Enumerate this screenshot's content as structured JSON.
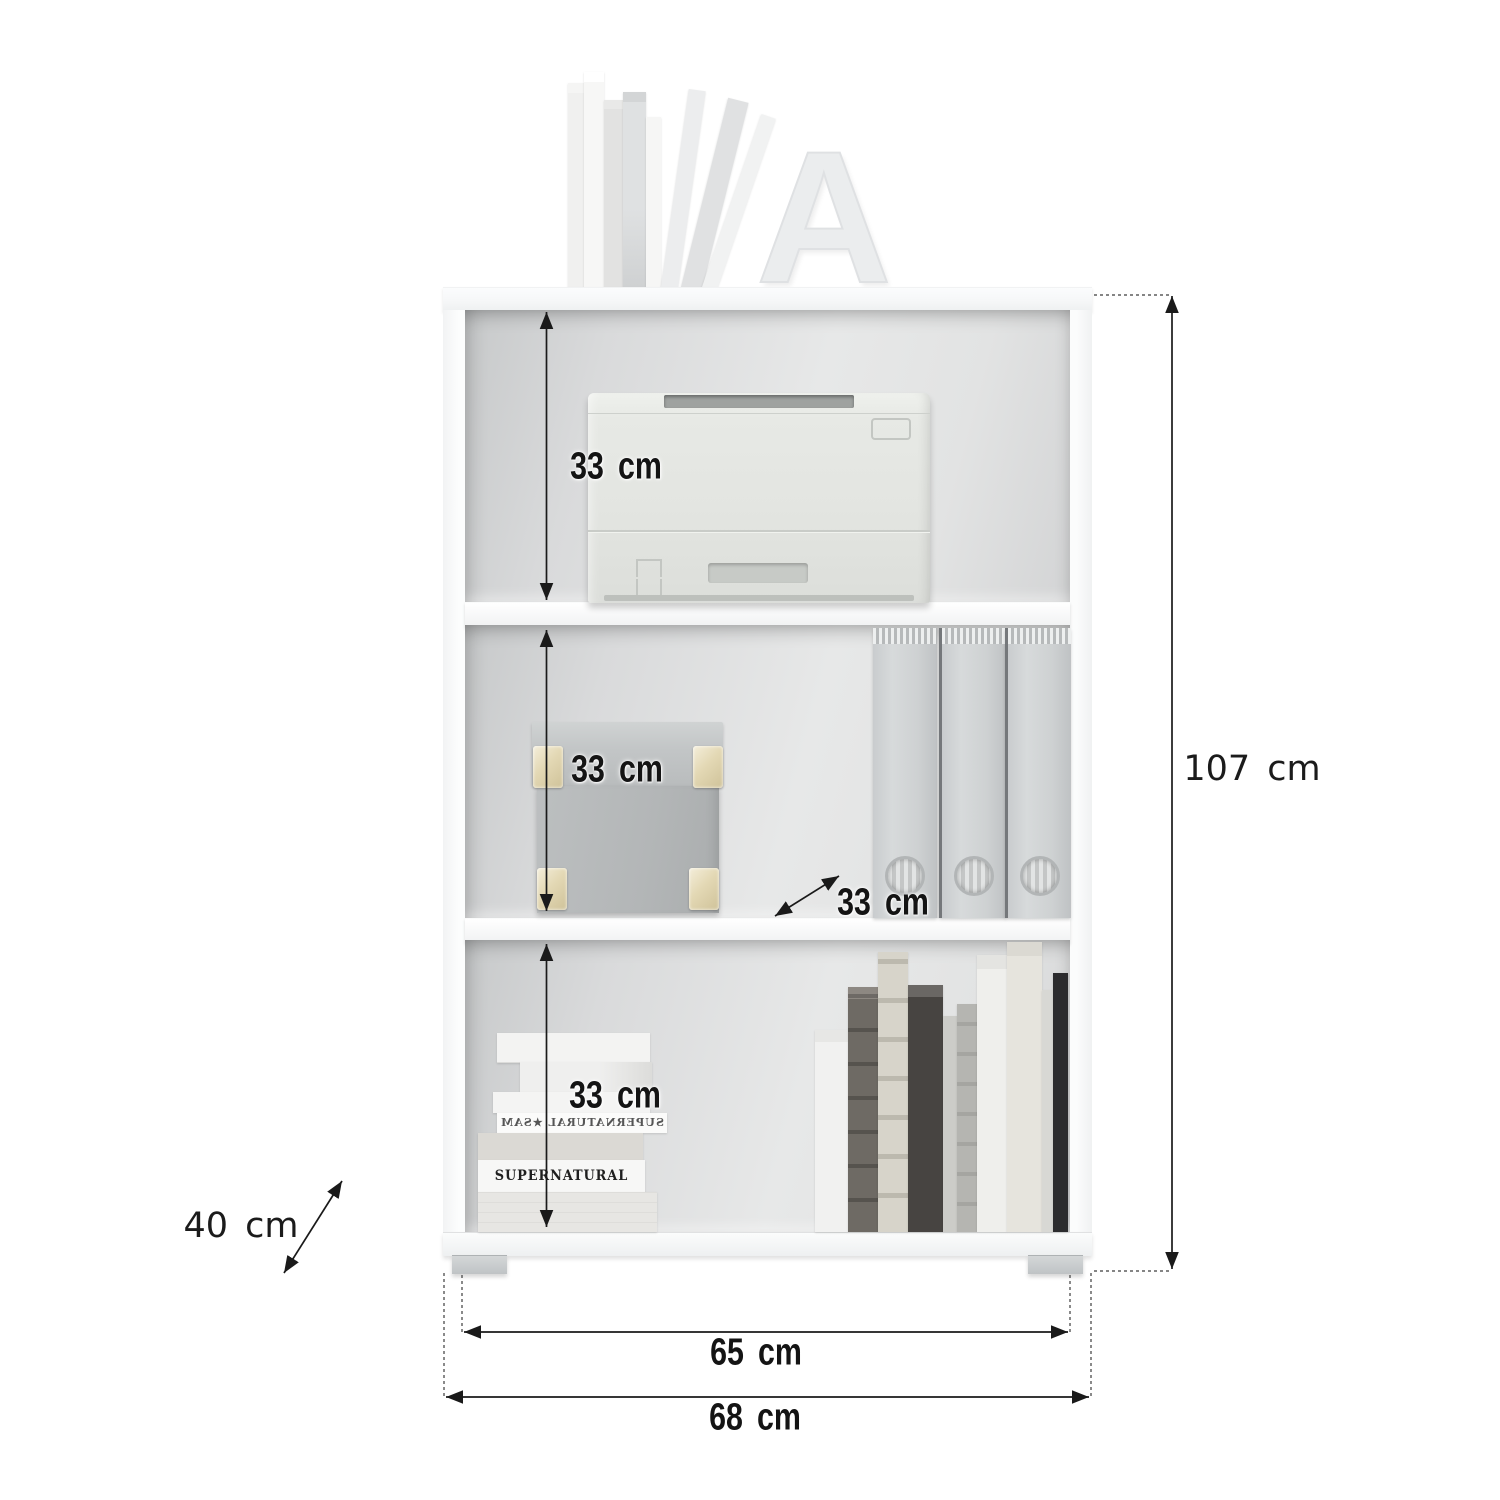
{
  "figure": {
    "labels": {
      "top_compartment_height": "33 cm",
      "middle_compartment_height": "33 cm",
      "bottom_compartment_height": "33 cm",
      "compartment_depth": "33 cm",
      "total_height": "107 cm",
      "total_depth": "40 cm",
      "inner_width": "65 cm",
      "total_width": "68 cm"
    },
    "decor": {
      "letter_a": "A",
      "book_spine_title": "SUPERNATURAL ★SAM & DIN",
      "book_spine_title_mirrored": "SUPERNATURAL ★SAM & DIN"
    },
    "colors": {
      "dimension_lines": "#1a1a1a",
      "interior_gray": "#d9dadb",
      "cabinet_white": "#fafbfb",
      "gold_corner": "#dfd3ac"
    }
  }
}
